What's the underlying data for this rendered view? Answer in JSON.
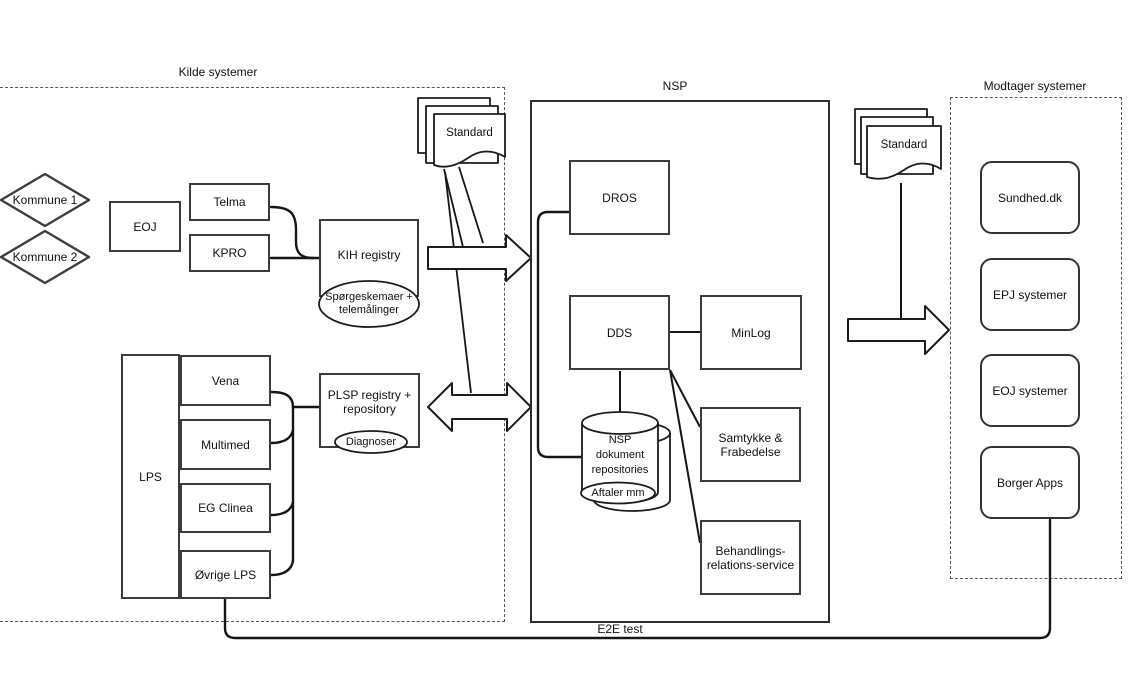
{
  "regions": {
    "kilde_label": "Kilde systemer",
    "nsp_label": "NSP",
    "modtager_label": "Modtager systemer",
    "e2e_label": "E2E test"
  },
  "kilde": {
    "kommune1": "Kommune 1",
    "kommune2": "Kommune 2",
    "eoj": "EOJ",
    "telma": "Telma",
    "kpro": "KPRO",
    "kih_label": "KIH registry",
    "kih_ellipse_line1": "Spørgeskemaer +",
    "kih_ellipse_line2": "telemålinger",
    "standard_doc": "Standard",
    "lps": "LPS",
    "vena": "Vena",
    "multimed": "Multimed",
    "eg_clinea": "EG Clinea",
    "ovrige_lps": "Øvrige LPS",
    "plsp_line1": "PLSP registry +",
    "plsp_line2": "repository",
    "plsp_ellipse": "Diagnoser"
  },
  "nsp": {
    "dros": "DROS",
    "dds": "DDS",
    "minlog": "MinLog",
    "repo_line1": "NSP",
    "repo_line2": "dokument",
    "repo_line3": "repositories",
    "repo_ellipse": "Aftaler mm",
    "samtykke_line1": "Samtykke &",
    "samtykke_line2": "Frabedelse",
    "behandlings_line1": "Behandlings-",
    "behandlings_line2": "relations-service"
  },
  "modtager": {
    "standard_doc": "Standard",
    "items": [
      {
        "label": "Sundhed.dk"
      },
      {
        "label": "EPJ systemer"
      },
      {
        "label": "EOJ systemer"
      },
      {
        "label": "Borger Apps"
      }
    ]
  }
}
